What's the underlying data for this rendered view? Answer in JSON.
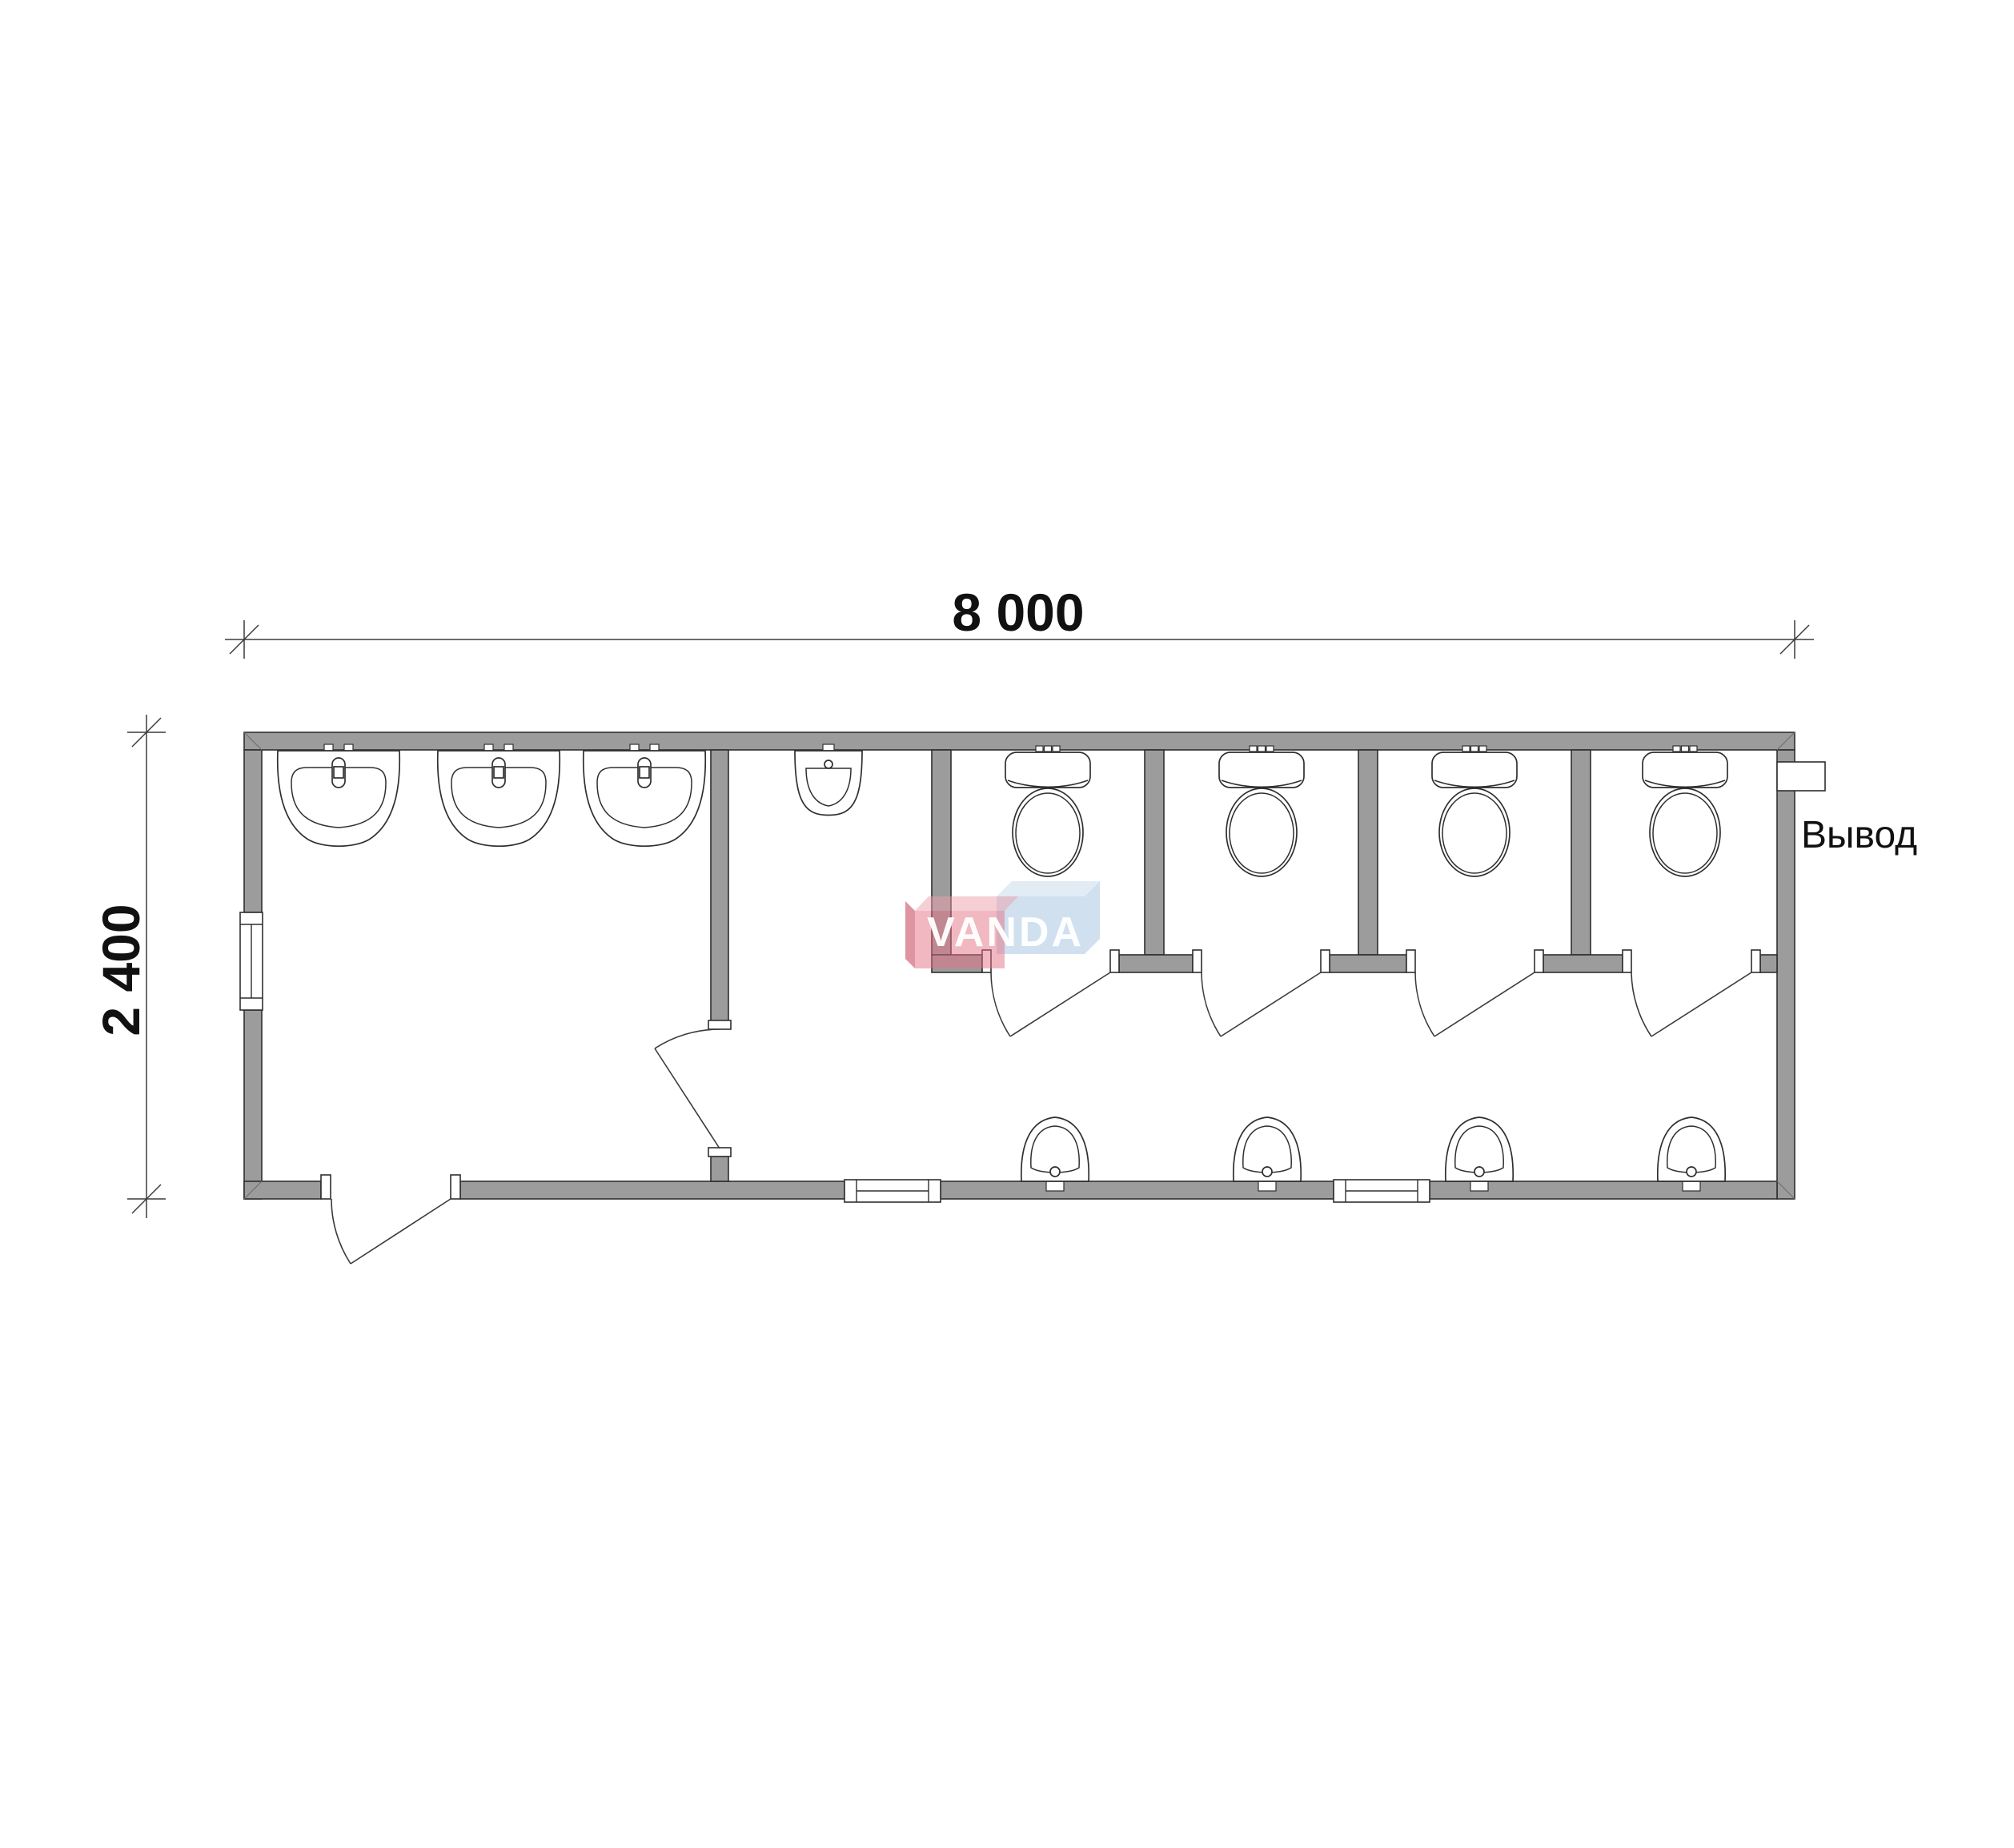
{
  "plan": {
    "dim_width_label": "8 000",
    "dim_height_label": "2 400",
    "outlet_label": "Вывод",
    "watermark_text": "VANDA",
    "fixture_counts": {
      "washbasins": 3,
      "urinals": 1,
      "toilets": 4,
      "hand_sinks": 4,
      "toilet_stalls": 4,
      "windows": 3,
      "entrance_doors": 1,
      "interior_doors": 5
    },
    "colors": {
      "wall": "#9c9c9c",
      "line": "#2f2f2f",
      "dim_line": "#3c3c3c",
      "text": "#111111",
      "watermark_pink": "rgba(227,113,132,0.50)",
      "watermark_pink_side": "rgba(196,60,84,0.55)",
      "watermark_pink_top": "rgba(238,160,172,0.50)",
      "watermark_blue": "rgba(151,186,219,0.45)",
      "watermark_blue_top": "rgba(190,212,233,0.45)",
      "watermark_letters": "rgba(255,255,255,0.95)"
    }
  }
}
